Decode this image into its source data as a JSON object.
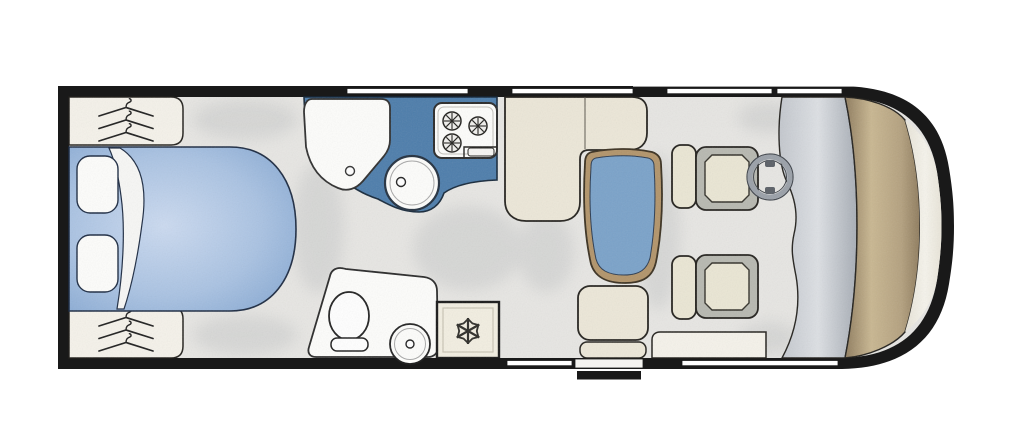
{
  "app": {
    "title": "Motorhome floor plan (top view)"
  },
  "palette": {
    "background": "#ffffff",
    "wall": "#191919",
    "floor": "#e7e6e3",
    "cream": "#ece7d8",
    "cream_light": "#f5f2ea",
    "fridge_cream": "#f2eee1",
    "white_fixture": "#fdfdfb",
    "counter_blue": "#4d7dab",
    "table_blue": "#7aa2c9",
    "wood_trim": "#b2946a",
    "bed_blue_center": "#cbdaf0",
    "bed_blue_edge": "#7fa3cf",
    "seat_gray": "#b7b8b0",
    "seat_cream": "#eae6d4",
    "dashboard_silver": "#c3c7cd",
    "overcab_tan": "#c9b791",
    "front_cream": "#f2efe7",
    "outline": "#23211d",
    "window_white": "#ffffff"
  },
  "labels": {
    "floorplan_title": "Motorhome floor plan",
    "shell": "Vehicle body shell",
    "floor": "Interior floor",
    "bedroom": "Rear bedroom",
    "bed": "Double bed",
    "sheet_fold": "Turned-back sheet",
    "pillow_top": "Pillow",
    "pillow_bottom": "Pillow",
    "wardrobe_top": "Wardrobe with hanging rail",
    "wardrobe_bottom": "Wardrobe with hanging rail",
    "kitchen": "Kitchen",
    "kitchen_counter": "Kitchen worktop",
    "sink_unit": "Kitchen sink / drainer unit",
    "round_sink": "Round sink bowl",
    "hob": "Three-burner gas hob",
    "bathroom": "Washroom",
    "toilet": "Toilet",
    "washbasin": "Washbasin",
    "fridge": "Refrigerator",
    "dinette": "Dinette",
    "sofa": "L-shaped lounge seating",
    "table": "Pedestal table",
    "travel_seat": "Forward-facing travel seat",
    "side_cabinet": "Low side cabinet",
    "cab": "Driving cab",
    "driver_seat": "Swivelled driver seat",
    "passenger_seat": "Swivelled passenger seat",
    "steering_wheel": "Steering wheel",
    "dashboard": "Dashboard",
    "overcab": "Over-cab area",
    "windscreen": "Windscreen / front cap",
    "entry_step": "Entry step",
    "windows": "Windows"
  },
  "features": {
    "windows_top": 4,
    "windows_bottom": 2,
    "hob_burners": 3,
    "wardrobes": 2,
    "hangers_per_wardrobe": 3,
    "cab_seats": 2,
    "entry_step": true
  }
}
